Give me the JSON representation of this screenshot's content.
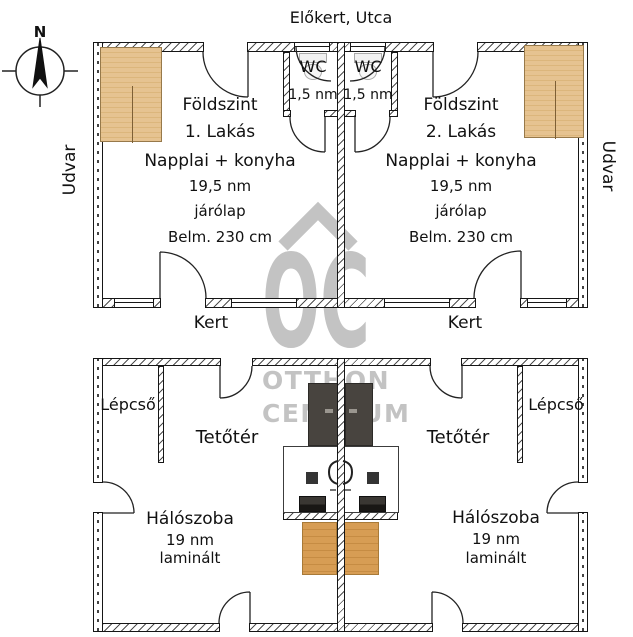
{
  "header": {
    "street": "Előkert, Utca"
  },
  "compass": {
    "north": "N"
  },
  "sides": {
    "left_yard": "Udvar",
    "right_yard": "Udvar",
    "left_garden": "Kert",
    "right_garden": "Kert"
  },
  "watermark": {
    "monogram": "OC",
    "name_line1": "OTTHON",
    "name_line2": "CENTRUM"
  },
  "ground_floor": {
    "flat1": {
      "level": "Földszint",
      "unit": "1. Lakás",
      "room": "Napplai + konyha",
      "area": "19,5 nm",
      "floor_material": "járólap",
      "ceiling": "Belm. 230 cm",
      "wc": {
        "label": "WC",
        "area": "1,5 nm"
      }
    },
    "flat2": {
      "level": "Földszint",
      "unit": "2. Lakás",
      "room": "Napplai + konyha",
      "area": "19,5 nm",
      "floor_material": "járólap",
      "ceiling": "Belm. 230 cm",
      "wc": {
        "label": "WC",
        "area": "1,5 nm"
      }
    }
  },
  "attic": {
    "flat1": {
      "stairs": "Lépcső",
      "loft": "Tetőtér",
      "bedroom": "Hálószoba",
      "area": "19 nm",
      "floor_material": "laminált"
    },
    "flat2": {
      "stairs": "Lépcső",
      "loft": "Tetőtér",
      "bedroom": "Hálószoba",
      "area": "19 nm",
      "floor_material": "laminált"
    }
  },
  "colors": {
    "wall-line": "#161616",
    "wardrobe": "#e6c391",
    "wardrobe-stripe": "#dcb67c",
    "bed": "#d79d54",
    "bed-stripe": "#c68c43",
    "dark-furniture": "#48443f",
    "watermark": "#c3c3c3"
  }
}
